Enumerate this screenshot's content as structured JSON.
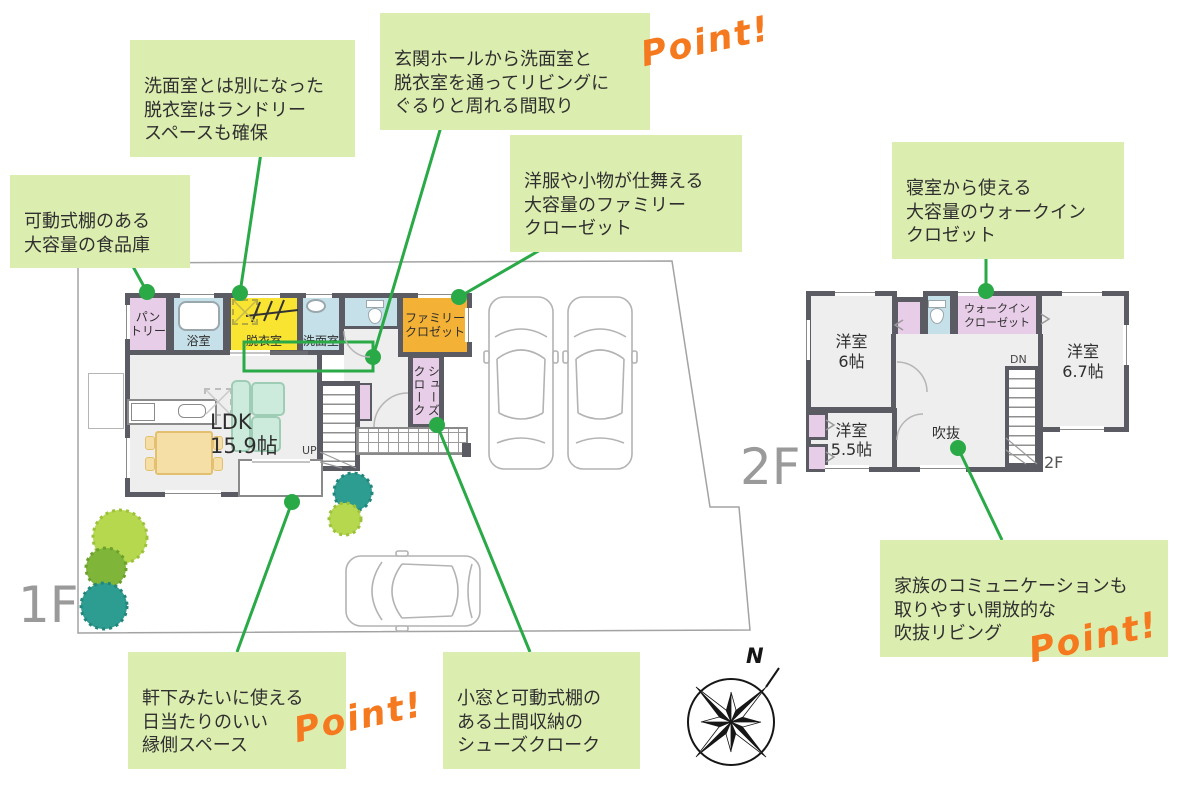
{
  "page": {
    "floor1_label": "1F",
    "floor2_label": "2F",
    "floor2_small_label": "2F",
    "compass_north": "N",
    "point_label": "Point!"
  },
  "callouts": {
    "laundry": {
      "text": "洗面室とは別になった\n脱衣室はランドリー\nスペースも確保"
    },
    "pantry": {
      "text": "可動式棚のある\n大容量の食品庫"
    },
    "circulation": {
      "text": "玄関ホールから洗面室と\n脱衣室を通ってリビングに\nぐるりと周れる間取り"
    },
    "family_closet": {
      "text": "洋服や小物が仕舞える\n大容量のファミリー\nクローゼット"
    },
    "walkin_closet": {
      "text": "寝室から使える\n大容量のウォークイン\nクロゼット"
    },
    "engawa": {
      "text": "軒下みたいに使える\n日当たりのいい\n縁側スペース"
    },
    "shoe_closet": {
      "text": "小窓と可動式棚の\nある土間収納の\nシューズクローク"
    },
    "void_living": {
      "text": "家族のコミュニケーションも\n取りやすい開放的な\n吹抜リビング"
    }
  },
  "floor1": {
    "pantry": "パン\nトリー",
    "bath": "浴室",
    "dressing": "脱衣室",
    "washroom": "洗面室",
    "family_closet": "ファミリー\nクロゼット",
    "shoe_closet": "シューズ\nクローク",
    "ldk": "LDK\n15.9帖",
    "up": "UP"
  },
  "floor2": {
    "bedroom6": "洋室\n6帖",
    "bedroom67": "洋室\n6.7帖",
    "bedroom55": "洋室\n5.5帖",
    "walkin_closet": "ウォークイン\nクローゼット",
    "void": "吹抜",
    "down": "DN"
  },
  "colors": {
    "accent_green": "#2aa947",
    "callout_bg": "#dcedb0",
    "point_orange": "#f4791f",
    "wall": "#5b5b63",
    "room_pink": "#e7cde7",
    "room_yellow": "#f9e431",
    "room_blue": "#c6e0e9",
    "room_orange": "#f3b135",
    "sofa_mint": "#cdebdc",
    "table_tan": "#f6dfa6",
    "tree_light_green": "#b6d84e",
    "tree_olive": "#7fb63a",
    "tree_teal": "#2d9d92"
  }
}
